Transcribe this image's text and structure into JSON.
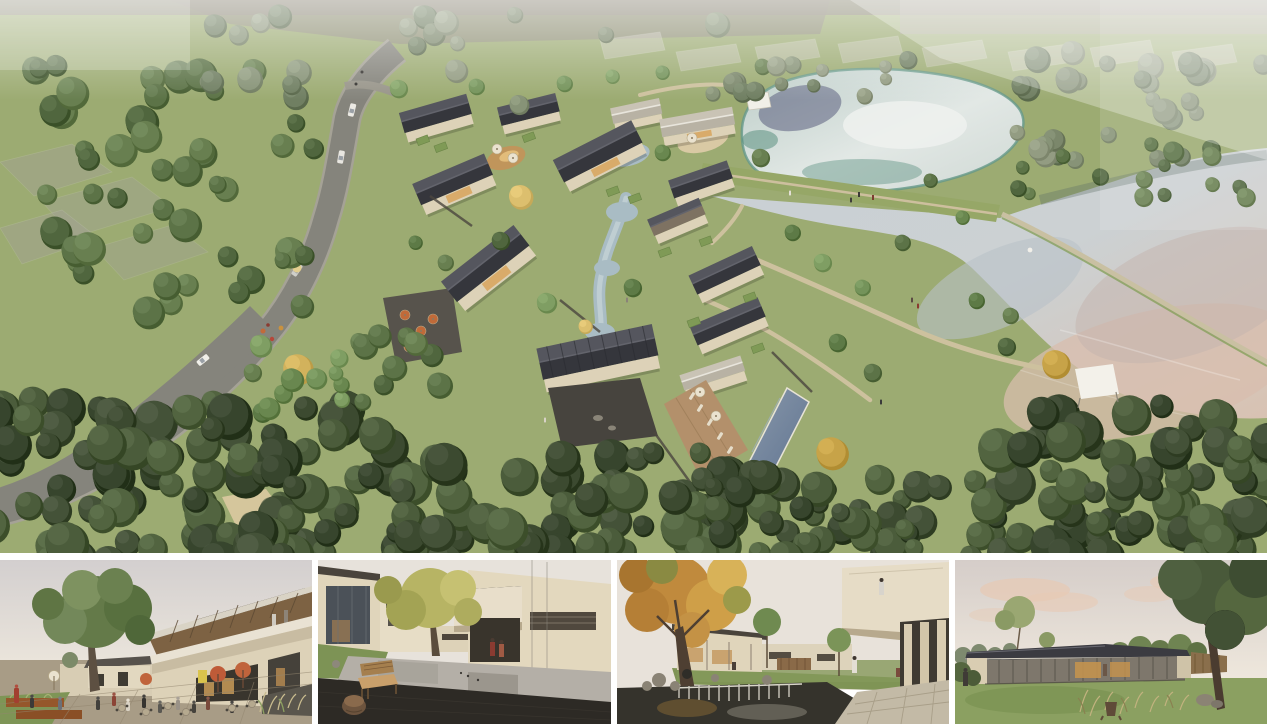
{
  "panels": {
    "aerial": {
      "name": "aerial-masterplan-render",
      "alt": "Aerial rendering of a courtyard-house resort village with dark pitched roofs beside two reflective ponds, an earth dam walkway, a diagonal swimming pool with wood deck, a winding grey access road with cars on the left, faded existing structures at the top, and dense woodland framing the bottom"
    },
    "thumbnails": [
      {
        "name": "street-plaza-render",
        "alt": "Eye-level render of a village shopping street plaza with cafe tables, two red-orange umbrellas, many visitors, a corten planter, ornamental grasses and a large green tree beside a two-storey timber-soffit building"
      },
      {
        "name": "water-courtyard-render",
        "alt": "Render of a calm water courtyard framed by beige volumes, a yellow-green tree, a wooden bench with carved stump table on a dark deck, and two figures in red coats inside a shaded portal"
      },
      {
        "name": "garden-pond-render",
        "alt": "Render of a garden pond with a weir waterfall and rocks under a large autumn tree, below a cantilevered guest wing with a figure at the parapet and a stone colonnade terrace"
      },
      {
        "name": "lawn-pavilion-render",
        "alt": "Dusk render of a single-storey glass pavilion with a dark metal roof glowing warmly on a lawn with ornamental grasses, rocks, a stump and a large dark tree"
      }
    ]
  },
  "palette": {
    "grass": "#9cab72",
    "grass_light": "#aab97f",
    "grass_dark": "#84995c",
    "forest_dark": "#3c4a30",
    "forest_mid": "#51633f",
    "tree_green": "#6f8c52",
    "tree_muted": "#7c8a68",
    "tree_gold": "#d2b25c",
    "roof_dark": "#35363c",
    "roof_light": "#55565e",
    "roof_pale": "#c9c3b5",
    "wall": "#ddd2b8",
    "wall_shadow": "#c2b49a",
    "road": "#85847c",
    "road_casing": "#a5a296",
    "path_tan": "#cdc19e",
    "water_silver": "#d6dcda",
    "water_teal": "#5b9484",
    "water_navy": "#41436a",
    "lake_silver": "#c6ced2",
    "lake_peach": "#d6bcab",
    "stream": "#a9bcc4",
    "pool": "#76879d",
    "deck": "#b3906b",
    "stone": "#4c4842",
    "umbrella_cream": "#eae2cf",
    "umbrella_orange": "#c06a39",
    "sky_gray": "#d6d2d0",
    "sky_warm": "#ece5da",
    "cloud_peach": "#e7c9b4",
    "floor_dark": "#2d2a25",
    "autumn": "#c58f3f",
    "wood": "#8a6a48",
    "glow": "#d8a55c",
    "gutter": "#ffffff"
  }
}
